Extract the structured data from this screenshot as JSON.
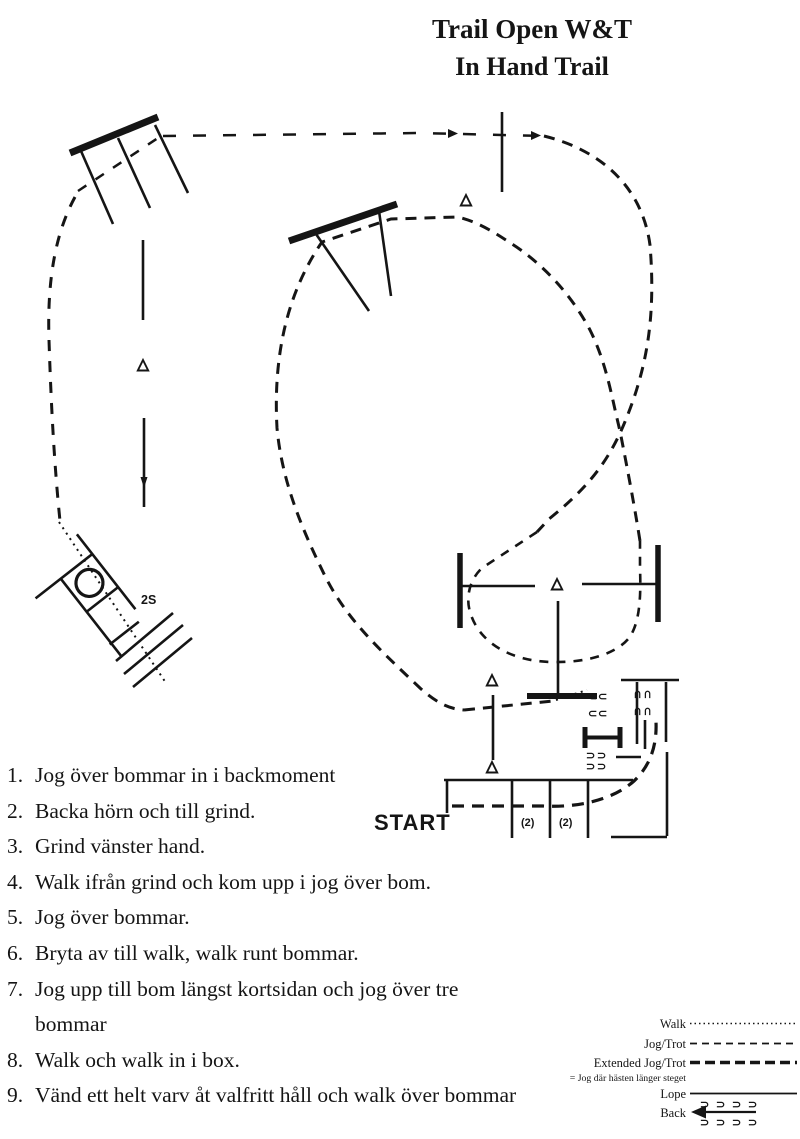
{
  "title": {
    "line1": "Trail Open W&T",
    "line2": "In Hand Trail"
  },
  "instructions": [
    {
      "num": "1.",
      "text": "Jog över bommar in i backmoment"
    },
    {
      "num": "2.",
      "text": "Backa hörn och till grind."
    },
    {
      "num": "3.",
      "text": "Grind vänster hand."
    },
    {
      "num": "4.",
      "text": "Walk ifrån grind och kom upp i jog över bom."
    },
    {
      "num": "5.",
      "text": "Jog över bommar."
    },
    {
      "num": "6.",
      "text": "Bryta av till walk, walk runt bommar."
    },
    {
      "num": "7.",
      "text": "Jog upp till bom längst kortsidan och jog över tre bommar"
    },
    {
      "num": "8.",
      "text": "Walk och walk in i box."
    },
    {
      "num": "9.",
      "text": "Vänd ett helt varv åt valfritt håll och walk över bommar"
    }
  ],
  "diagram": {
    "start_label": "START",
    "gate_label": "2S",
    "distance_label_1": "(2)",
    "distance_label_2": "(2)"
  },
  "legend": {
    "entries": [
      {
        "label": "Walk",
        "style": "dotted"
      },
      {
        "label": "Jog/Trot",
        "style": "dashed"
      },
      {
        "label": "Extended Jog/Trot",
        "style": "heavy-dashed"
      },
      {
        "label": "Lope",
        "style": "solid"
      },
      {
        "label": "Back",
        "style": "hoofprint-arrow"
      }
    ],
    "extended_note": "= Jog där hästen länger steget"
  },
  "icons": {
    "hoofprint_left": "⊃",
    "hoofprint_right": "⊂"
  },
  "colors": {
    "ink": "#151515",
    "background": "#ffffff"
  }
}
